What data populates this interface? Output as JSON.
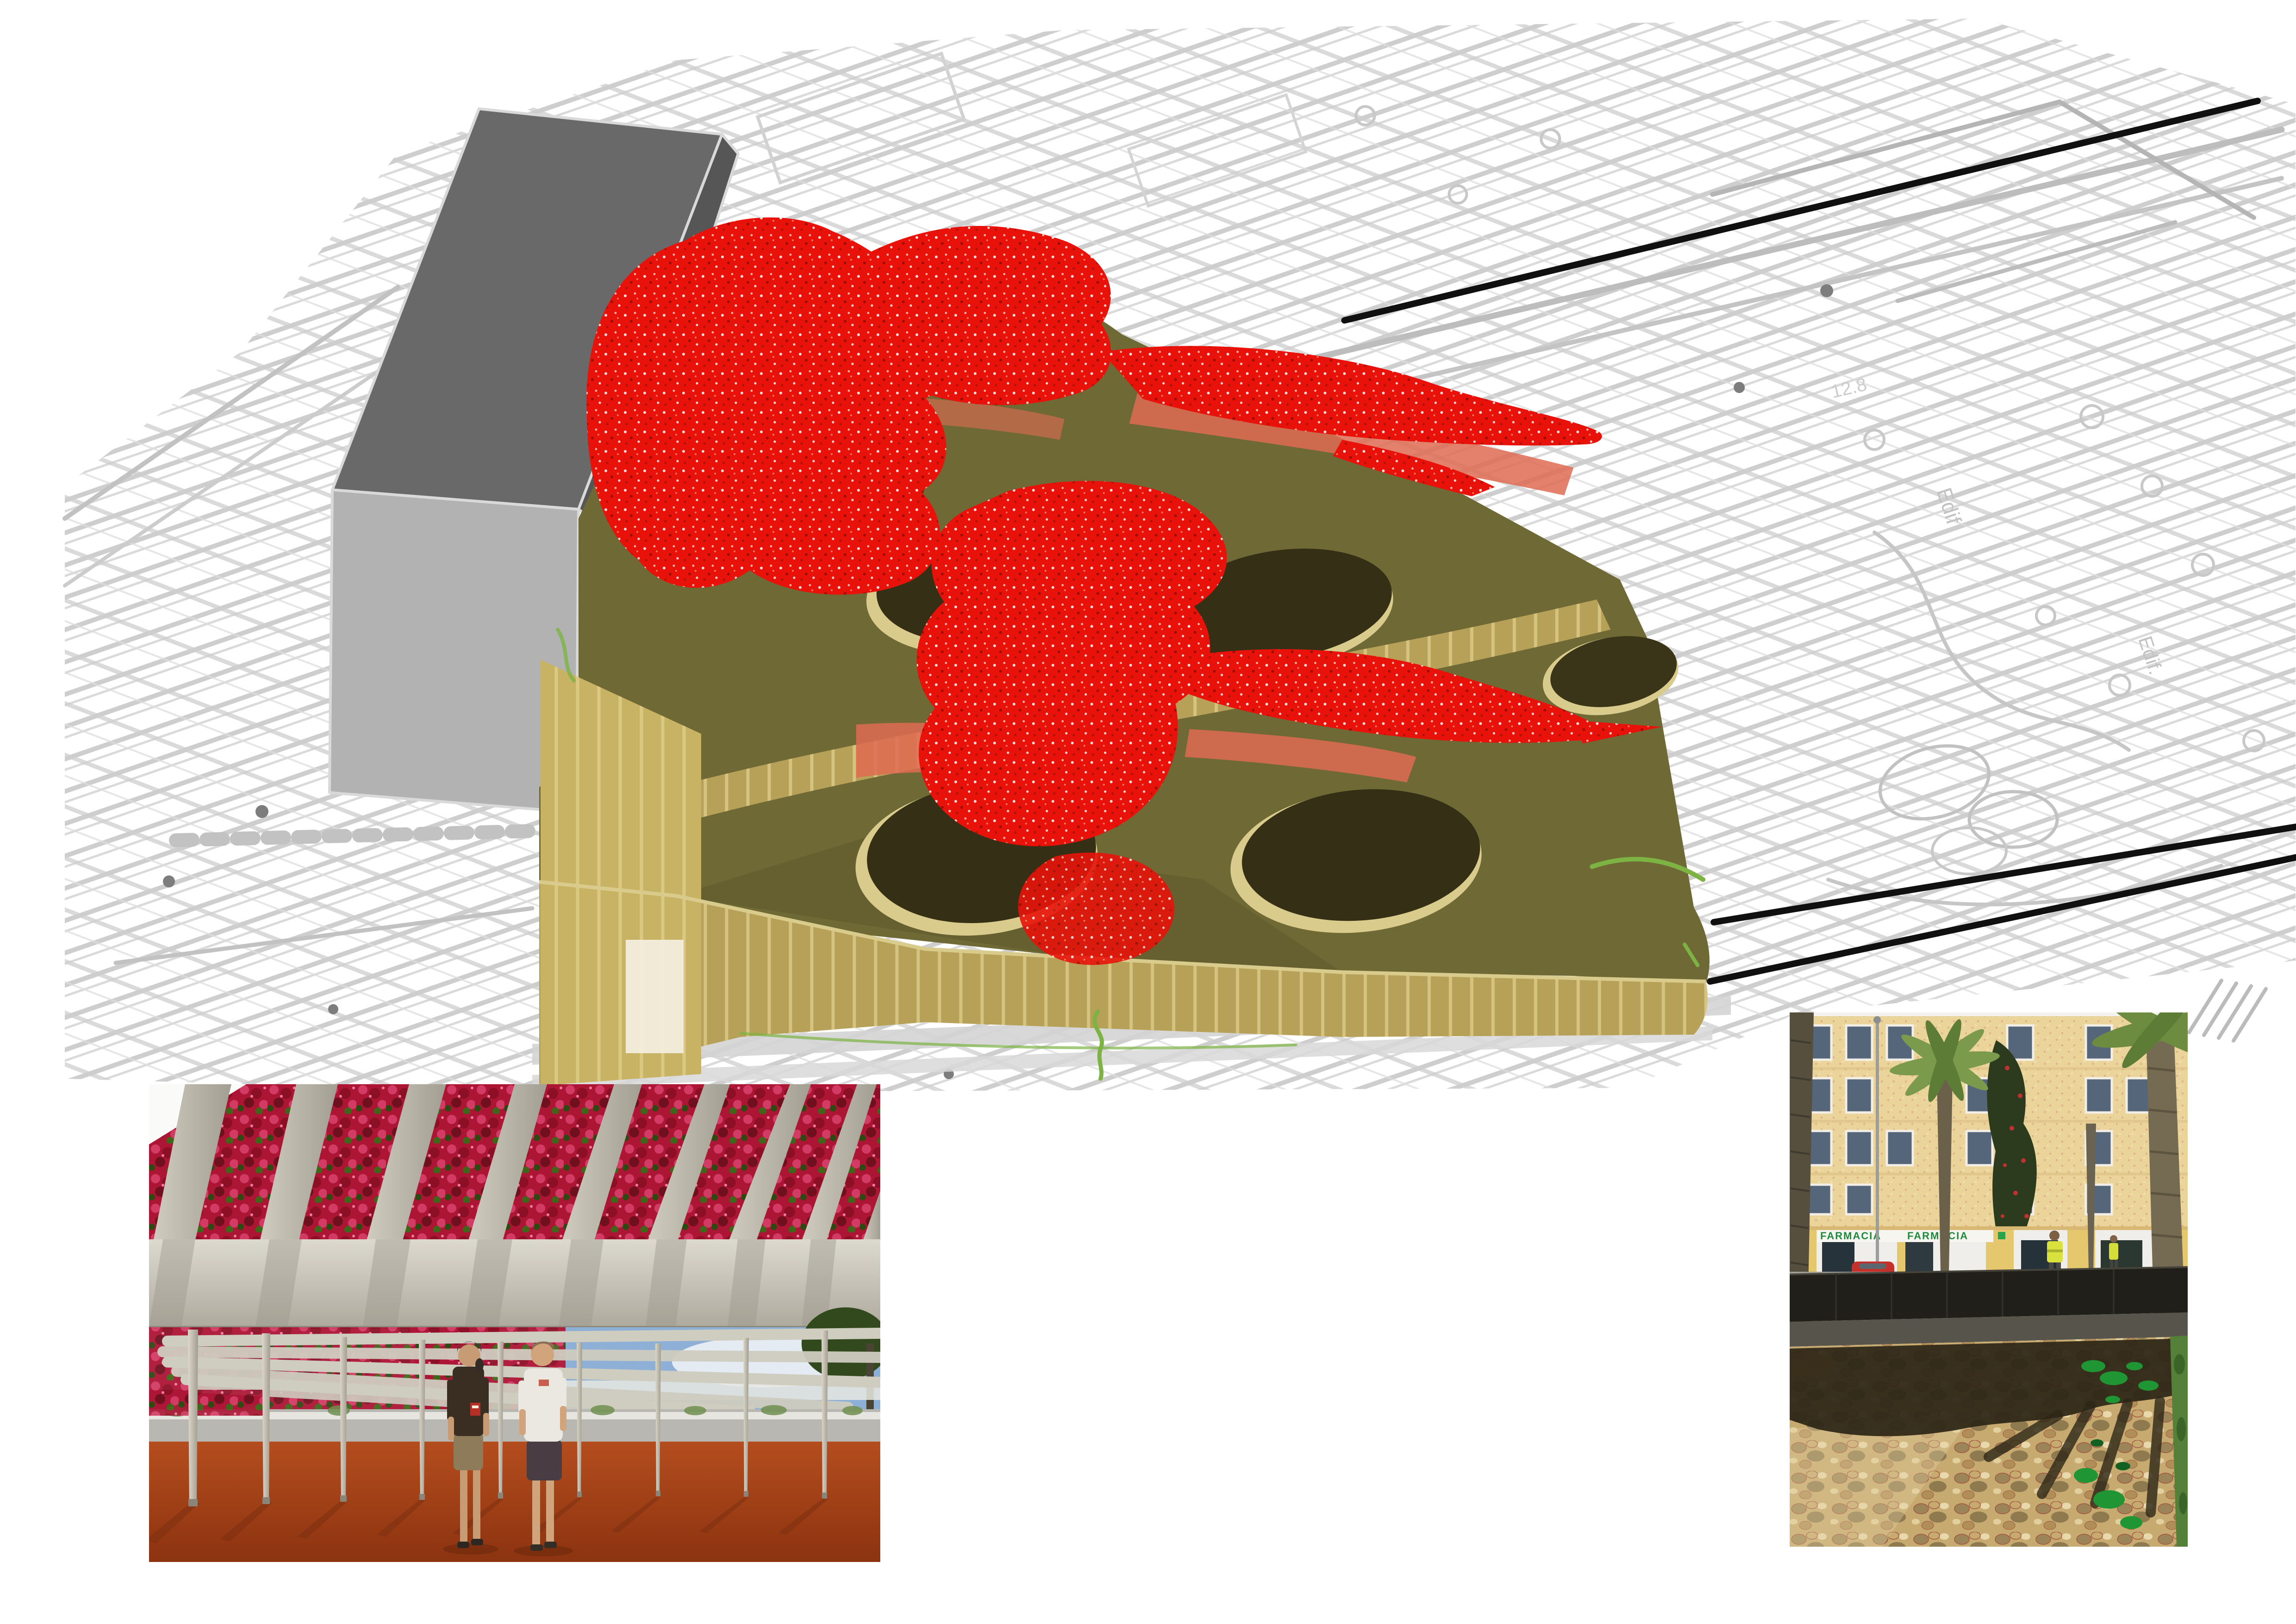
{
  "document": {
    "kind": "architecture-presentation-board",
    "background": "#ffffff"
  },
  "site_plan": {
    "line_color": "#c9c9c9",
    "accent_line_color": "#b5b5b5",
    "labels": [
      {
        "text": "Edif"
      },
      {
        "text": "Edif."
      },
      {
        "text": "12.8"
      }
    ]
  },
  "section_lines": {
    "color": "#101010",
    "count": 3
  },
  "massing_model": {
    "building_top_color": "#696969",
    "building_side_color": "#b2b2b2",
    "building_shade_color": "#565656",
    "podium_wall_color": "#b7a159",
    "podium_wall_light": "#cdb96b",
    "deck_color": "#6f6936",
    "courtyard_color": "#352f15",
    "courtyard_rim_color": "#d9cb8c",
    "canopy_color": "#e8120a",
    "canopy_shadow_color": "#df6b52",
    "accent_green": "#7cb342",
    "courtyard_count": 5
  },
  "photos": {
    "pergola": {
      "flower_color": "#ad1535",
      "beam_color": "#c3bfb2",
      "ground_color": "#a3430f",
      "sky_color": "#8fb0d6",
      "people_count": 2
    },
    "street": {
      "pharmacy_sign_left": "FARMACIA",
      "pharmacy_sign_right": "FARMACIA",
      "facade_color": "#ebd49a",
      "ground_color": "#c7aa70",
      "fence_color": "#201f19",
      "plant_color": "#1f9633"
    }
  }
}
